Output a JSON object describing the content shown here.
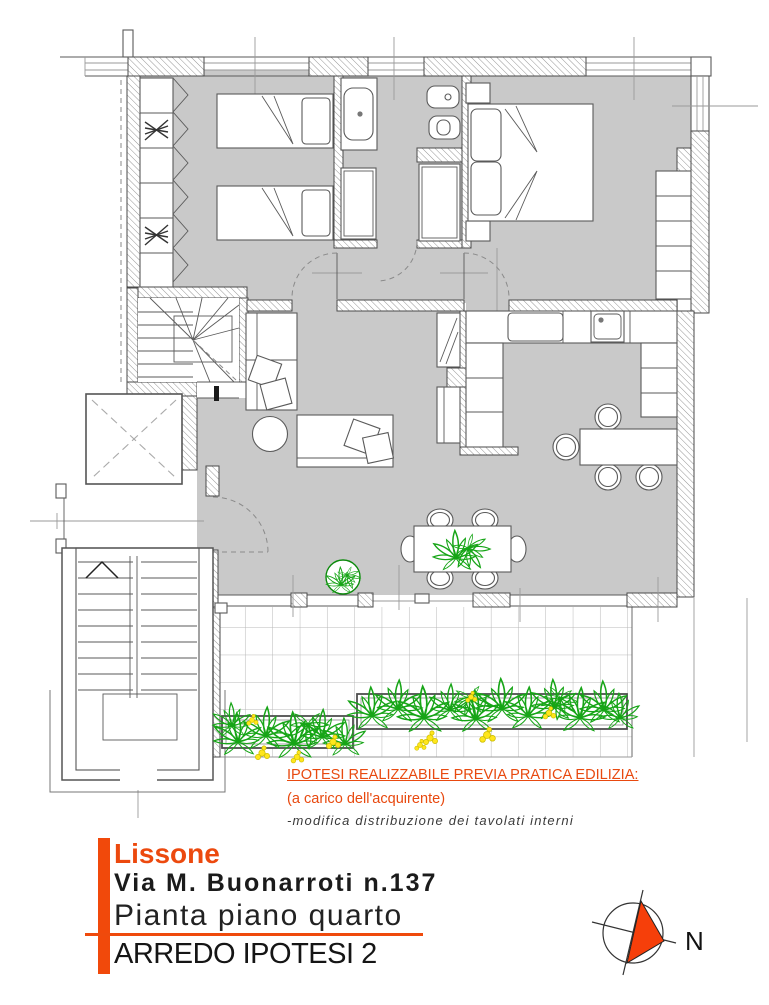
{
  "annotations": {
    "line1": "IPOTESI REALIZZABILE PREVIA PRATICA EDILIZIA:",
    "line2": "(a carico dell'acquirente)",
    "line3": "-modifica distribuzione dei tavolati interni"
  },
  "title_block": {
    "city": "Lissone",
    "address": "Via M. Buonarroti n.137",
    "plan_title": "Pianta piano quarto",
    "variant": "ARREDO IPOTESI 2"
  },
  "compass": {
    "label": "N"
  },
  "colors": {
    "accent_orange": "#ec490e",
    "bar_orange": "#f1490b",
    "compass_orange": "#f63f0a",
    "floor_gray": "#c9c9c9",
    "wall_line": "#4a4a4a",
    "plant_green": "#17a517",
    "flower_yellow": "#ffe61c",
    "tile_line": "#b8b8b8"
  },
  "floor_plan": {
    "rooms": [
      "bedroom-twin",
      "bathroom",
      "master-bedroom",
      "hallway",
      "kitchen",
      "living-dining-room",
      "private-staircase-room",
      "balcony",
      "elevator-shaft",
      "common-stairwell",
      "landing"
    ],
    "furniture": [
      "single-bed-1",
      "single-bed-2",
      "double-bed",
      "nightstands",
      "wardrobe-closet",
      "master-wardrobe",
      "sofa",
      "daybed",
      "round-side-table",
      "dining-table-with-six-chairs",
      "kitchen-table-with-chairs",
      "kitchen-counters",
      "tall-cabinets"
    ],
    "fixtures": [
      "washbasin",
      "bidet",
      "toilet",
      "shower",
      "kitchen-sink",
      "cooktop"
    ],
    "greenery": [
      "potted-plant-floor",
      "table-centerpiece-plant",
      "planter-box-left",
      "planter-box-right",
      "yellow-flowers"
    ]
  }
}
